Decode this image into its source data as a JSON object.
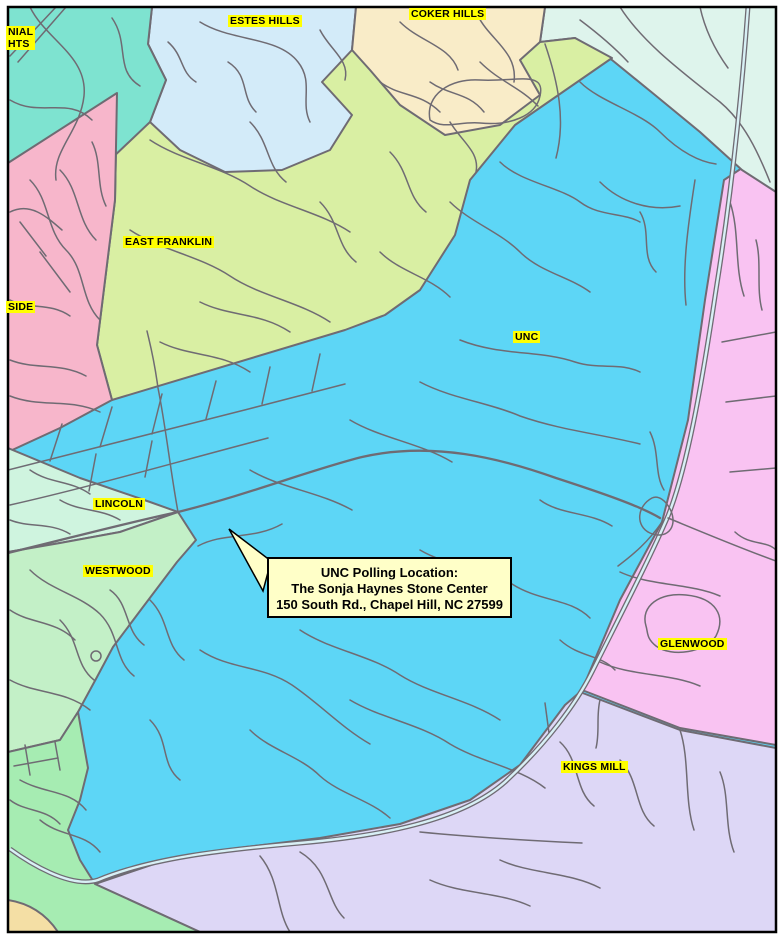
{
  "map": {
    "description": "Chapel Hill NC voting precinct map with UNC polling location callout",
    "region_labels": {
      "colonial_heights_line1": "NIAL",
      "colonial_heights_line2": "HTS",
      "estes_hills": "ESTES HILLS",
      "coker_hills": "COKER HILLS",
      "east_franklin": "EAST FRANKLIN",
      "side": "SIDE",
      "unc": "UNC",
      "lincoln": "LINCOLN",
      "westwood": "WESTWOOD",
      "glenwood": "GLENWOOD",
      "kings_mill": "KINGS MILL"
    },
    "callout": {
      "line1": "UNC Polling Location:",
      "line2": "The Sonja Haynes Stone Center",
      "line3": "150 South Rd., Chapel Hill, NC 27599"
    },
    "colors": {
      "unc_precinct": "#5DD6F6",
      "colonial_heights": "#7EE3D0",
      "estes_hills": "#D3EBF9",
      "coker_hills": "#F9ECC8",
      "northeast_area": "#DEF4EC",
      "east_franklin": "#D9EFA3",
      "northside": "#F7B6CB",
      "lincoln": "#CFF4DF",
      "westwood": "#C3F0C7",
      "southwest_area": "#A6ECB2",
      "corner_area": "#F4DFA5",
      "glenwood": "#F9C3F2",
      "kings_mill": "#DDD7F6",
      "road": "#6F6B73",
      "label_highlight": "#FFFF00",
      "callout_background": "#FFFFC8"
    }
  }
}
